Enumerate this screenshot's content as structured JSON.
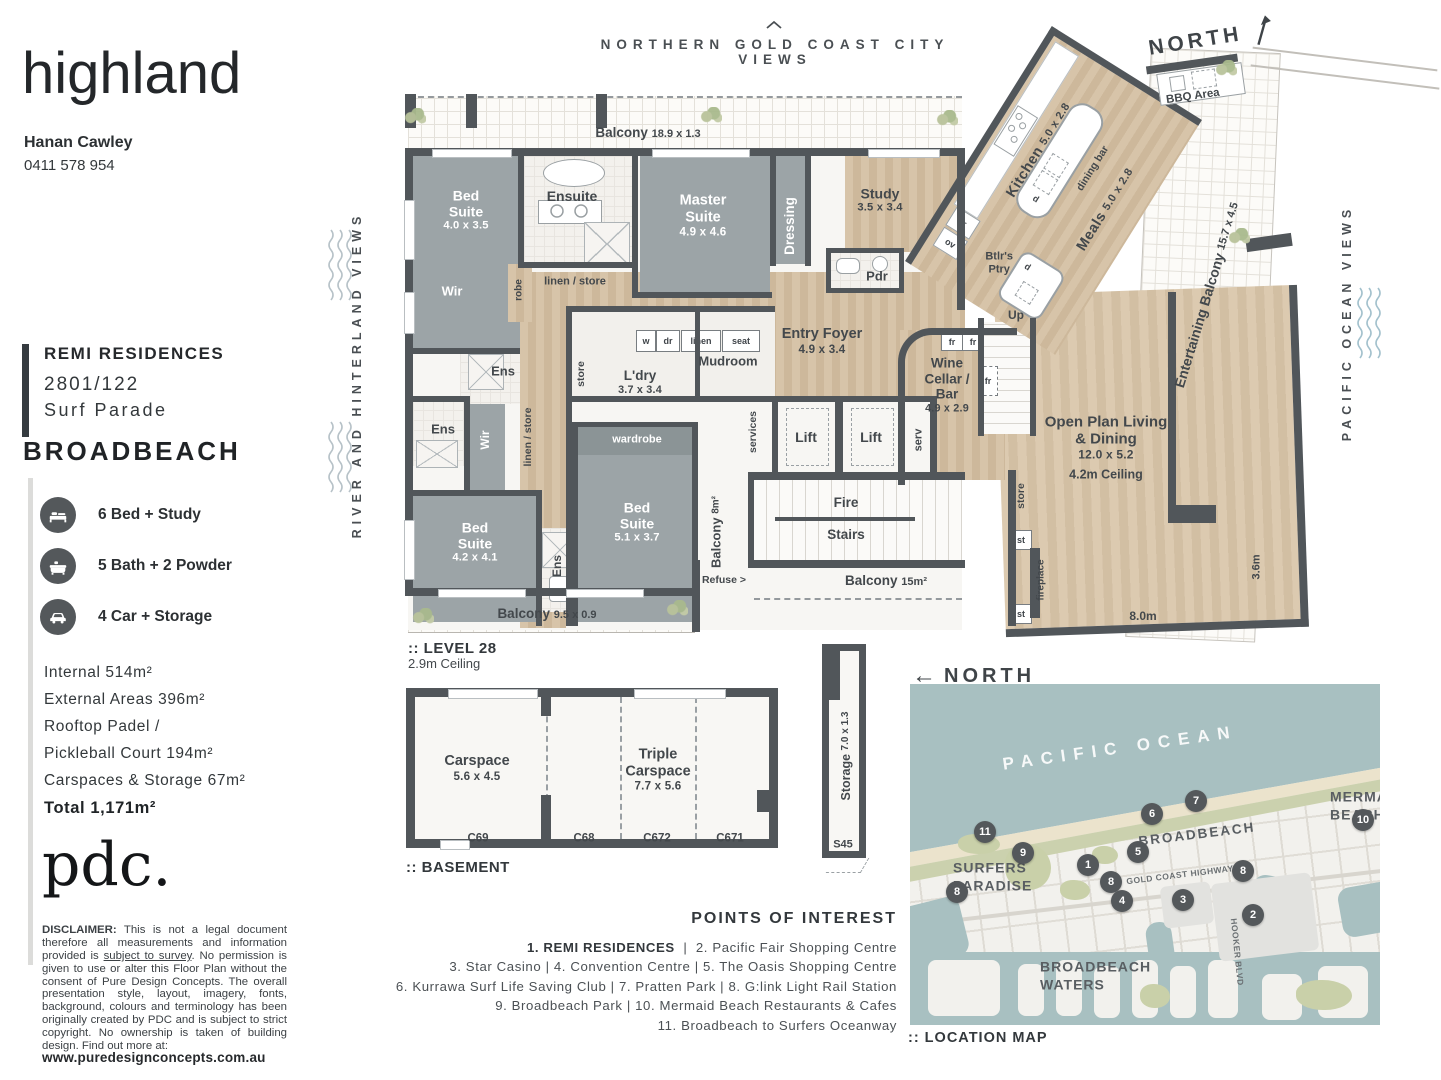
{
  "brand": {
    "logo": "highland",
    "agent": "Hanan Cawley",
    "phone": "0411 578 954"
  },
  "listing": {
    "building": "REMI RESIDENCES",
    "unit": "2801/122",
    "street": "Surf Parade",
    "suburb": "BROADBEACH"
  },
  "features": [
    {
      "icon": "bed-icon",
      "label": "6 Bed + Study"
    },
    {
      "icon": "bath-icon",
      "label": "5 Bath + 2 Powder"
    },
    {
      "icon": "car-icon",
      "label": "4 Car + Storage"
    }
  ],
  "areas": {
    "lines": [
      "Internal 514m²",
      "External Areas 396m²",
      "Rooftop Padel /",
      "Pickleball Court 194m²",
      "Carspaces & Storage 67m²"
    ],
    "total": "Total 1,171m²"
  },
  "pdc": {
    "logo": "pdc.",
    "disclaimer_label": "DISCLAIMER:",
    "body1": "This is not a legal document therefore all measurements and information provided is ",
    "underlined": "subject to survey",
    "body2": ". No permission is given to use or alter this Floor Plan without the consent of Pure Design Concepts. The overall presentation style, layout, imagery, fonts, background, colours and terminology has been originally created by PDC and is subject to strict copyright. No ownership is taken of building design. Find out more at:",
    "website": "www.puredesignconcepts.com.au"
  },
  "headers": {
    "top_caption": "NORTHERN GOLD COAST CITY VIEWS",
    "north": "NORTH",
    "left_view": "RIVER AND HINTERLAND VIEWS",
    "right_view": "PACIFIC OCEAN VIEWS"
  },
  "plan": {
    "level": ":: LEVEL 28",
    "ceiling": "2.9m Ceiling",
    "labels": {
      "balcony_top": "Balcony",
      "balcony_top_dim": "18.9 x 1.3",
      "bed1": "Bed Suite",
      "bed1_dim": "4.0 x 3.5",
      "wir1": "Wir",
      "ensuite": "Ensuite",
      "robe": "robe",
      "linen_store": "linen / store",
      "master": "Master Suite",
      "master_dim": "4.9 x 4.6",
      "dressing": "Dressing",
      "study": "Study",
      "study_dim": "3.5 x 3.4",
      "pdr": "Pdr",
      "ens": "Ens",
      "wir2": "Wir",
      "linen_store_v": "linen / store",
      "store": "store",
      "ldry": "L'dry",
      "ldry_dim": "3.7 x 3.4",
      "w": "w",
      "dr": "dr",
      "linen": "linen",
      "seat": "seat",
      "mudroom": "Mudroom",
      "entry": "Entry Foyer",
      "entry_dim": "4.9 x 3.4",
      "wine": "Wine Cellar / Bar",
      "wine_dim": "4.9 x 2.9",
      "fr": "fr",
      "ov": "ov",
      "btlr": "Btlr's Ptry",
      "d": "d",
      "up": "Up",
      "lift": "Lift",
      "serv": "serv",
      "services": "services",
      "wardrobe": "wardrobe",
      "bed2": "Bed Suite",
      "bed2_dim": "5.1 x 3.7",
      "bed3": "Bed Suite",
      "bed3_dim": "4.2 x 4.1",
      "balcony8": "Balcony",
      "balcony8_dim": "8m²",
      "fire": "Fire",
      "stairs": "Stairs",
      "refuse": "Refuse >",
      "balcony15": "Balcony",
      "balcony15_dim": "15m²",
      "balcony_bot": "Balcony",
      "balcony_bot_dim": "9.5 x 0.9",
      "kitchen": "Kitchen",
      "kitchen_dim": "5.0 x 2.8",
      "dining_bar": "dining bar",
      "meals": "Meals",
      "meals_dim": "5.0 x 2.8",
      "bbq": "BBQ Area",
      "ent_balc": "Entertaining Balcony",
      "ent_balc_dim": "15.7 x 4.5",
      "open": "Open Plan Living & Dining",
      "open_dim": "12.0 x 5.2",
      "open_ceiling": "4.2m Ceiling",
      "fireplace": "fireplace",
      "st": "st",
      "dim8": "8.0m",
      "dim36": "3.6m"
    }
  },
  "basement": {
    "title": ":: BASEMENT",
    "carspace": "Carspace",
    "carspace_dim": "5.6 x 4.5",
    "triple": "Triple Carspace",
    "triple_dim": "7.7 x 5.6",
    "bays": [
      "C69",
      "C68",
      "C672",
      "C671"
    ],
    "storage": "Storage",
    "storage_dim": "7.0 x 1.3",
    "storage_id": "S45"
  },
  "poi": {
    "title": "POINTS OF INTEREST",
    "line1_bold": "1. REMI RESIDENCES",
    "line1_rest": "  |  2. Pacific Fair Shopping Centre",
    "lines": [
      "3. Star Casino  |  4. Convention Centre  |  5. The Oasis Shopping Centre",
      "6. Kurrawa Surf Life Saving Club  |  7. Pratten Park  |  8. G:link Light Rail Station",
      "9. Broadbeach Park  |  10. Mermaid Beach Restaurants & Cafes",
      "11. Broadbeach to Surfers Oceanway"
    ]
  },
  "map": {
    "north": "NORTH",
    "north_arrow": "←",
    "caption": ":: LOCATION MAP",
    "ocean": "PACIFIC OCEAN",
    "mermaid1": "MERMAID",
    "mermaid2": "BEACH",
    "broadbeach": "BROADBEACH",
    "surfers1": "SURFERS",
    "surfers2": "PARADISE",
    "waters1": "BROADBEACH",
    "waters2": "WATERS",
    "highway": "GOLD COAST HIGHWAY",
    "hooker": "HOOKER BLVD",
    "markers": [
      {
        "n": "11",
        "x": 75,
        "y": 148
      },
      {
        "n": "9",
        "x": 113,
        "y": 169
      },
      {
        "n": "6",
        "x": 242,
        "y": 130
      },
      {
        "n": "7",
        "x": 286,
        "y": 117
      },
      {
        "n": "10",
        "x": 453,
        "y": 136
      },
      {
        "n": "5",
        "x": 228,
        "y": 168
      },
      {
        "n": "1",
        "x": 178,
        "y": 181
      },
      {
        "n": "8",
        "x": 201,
        "y": 198
      },
      {
        "n": "8",
        "x": 47,
        "y": 208
      },
      {
        "n": "8",
        "x": 333,
        "y": 187
      },
      {
        "n": "4",
        "x": 212,
        "y": 217
      },
      {
        "n": "3",
        "x": 273,
        "y": 216
      },
      {
        "n": "2",
        "x": 343,
        "y": 231
      }
    ]
  }
}
